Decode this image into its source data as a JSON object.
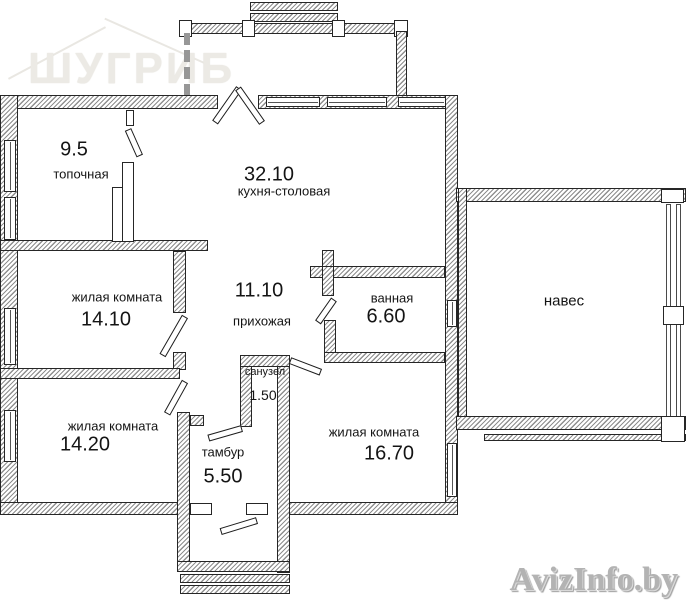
{
  "watermarks": {
    "logo": "ШУГРИБ",
    "site": "AvizInfo.by"
  },
  "rooms": [
    {
      "name": "топочная",
      "area": "9.5"
    },
    {
      "name": "кухня-столовая",
      "area": "32.10"
    },
    {
      "name": "жилая комната",
      "area": "14.10"
    },
    {
      "name": "прихожая",
      "area": "11.10"
    },
    {
      "name": "ванная",
      "area": "6.60"
    },
    {
      "name": "санузел",
      "area": "1.50"
    },
    {
      "name": "жилая комната",
      "area": "14.20"
    },
    {
      "name": "тамбур",
      "area": "5.50"
    },
    {
      "name": "жилая комната",
      "area": "16.70"
    },
    {
      "name": "навес",
      "area": ""
    }
  ]
}
